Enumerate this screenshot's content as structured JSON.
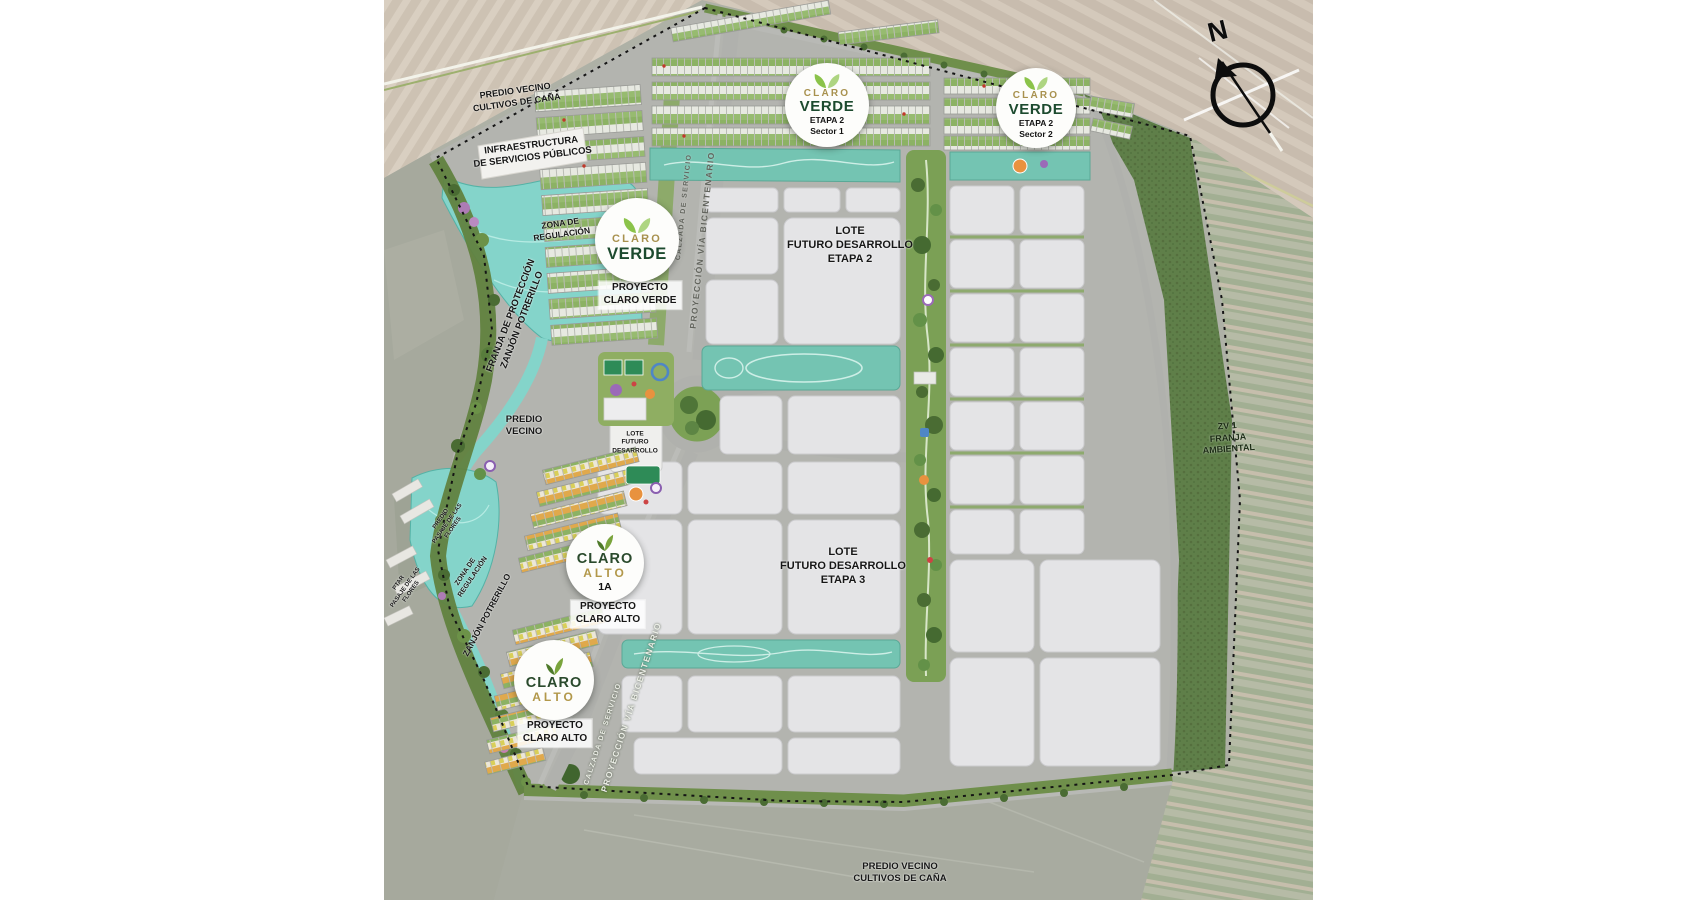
{
  "map": {
    "compass": {
      "north_label": "N"
    },
    "badges": {
      "claro_verde_sector1": {
        "brand_line1": "CLARO",
        "brand_line2": "VERDE",
        "etapa": "ETAPA 2",
        "sector": "Sector 1"
      },
      "claro_verde_sector2": {
        "brand_line1": "CLARO",
        "brand_line2": "VERDE",
        "etapa": "ETAPA 2",
        "sector": "Sector 2"
      },
      "claro_verde_main": {
        "brand_line1": "CLARO",
        "brand_line2": "VERDE"
      },
      "claro_alto_1a": {
        "brand_line1": "CLARO",
        "brand_line2": "ALTO",
        "stage": "1A"
      },
      "claro_alto_main": {
        "brand_line1": "CLARO",
        "brand_line2": "ALTO"
      }
    },
    "area_labels": {
      "predio_vecino_top": "PREDIO VECINO\nCULTIVOS DE CAÑA",
      "infraestructura": "INFRAESTRUCTURA\nDE SERVICIOS PÚBLICOS",
      "zona_regulacion_upper": "ZONA DE\nREGULACIÓN",
      "franja_proteccion": "FRANJA DE PROTECCIÓN\nZANJÓN POTRERILLO",
      "predio_vecino_left": "PREDIO\nVECINO",
      "proyecto_claro_verde": "PROYECTO\nCLARO VERDE",
      "lote_futuro_mini": "LOTE\nFUTURO\nDESARROLLO",
      "lote_futuro_etapa2": "LOTE\nFUTURO DESARROLLO\nETAPA 2",
      "lote_futuro_etapa3": "LOTE\nFUTURO DESARROLLO\nETAPA 3",
      "zv1_franja_ambiental": "ZV 1\nFRANJA\nAMBIENTAL",
      "proyecto_claro_alto_upper": "PROYECTO\nCLARO ALTO",
      "proyecto_claro_alto_lower": "PROYECTO\nCLARO ALTO",
      "predio_vecino_bottom": "PREDIO VECINO\nCULTIVOS DE CAÑA",
      "zona_regulacion_lower": "ZONA DE\nREGULACIÓN",
      "predio_pasaje_flores": "PREDIO\nPASAJE DE LAS\nFLORES",
      "ptar_pasaje_flores": "PTAR\nPASAJE DE LAS\nFLORES",
      "zanjon_potrerillo": "ZANJÓN POTRERILLO"
    },
    "road_labels": {
      "via_bicentenario_north": "PROYECCIÓN VÍA BICENTENARIO",
      "calzada_servicio_north": "CALZADA DE SERVICIO",
      "via_bicentenario_south": "PROYECCIÓN VÍA BICENTENARIO",
      "calzada_servicio_south": "CALZADA DE SERVICIO"
    },
    "colors": {
      "water_teal": "#84d4ca",
      "linear_park_teal": "#74c4b2",
      "ambient_green": "#5f7f49",
      "lot_gray": "#e4e4e6",
      "brand_gold": "#a8914e",
      "brand_green_dark": "#1c4a2e"
    }
  }
}
